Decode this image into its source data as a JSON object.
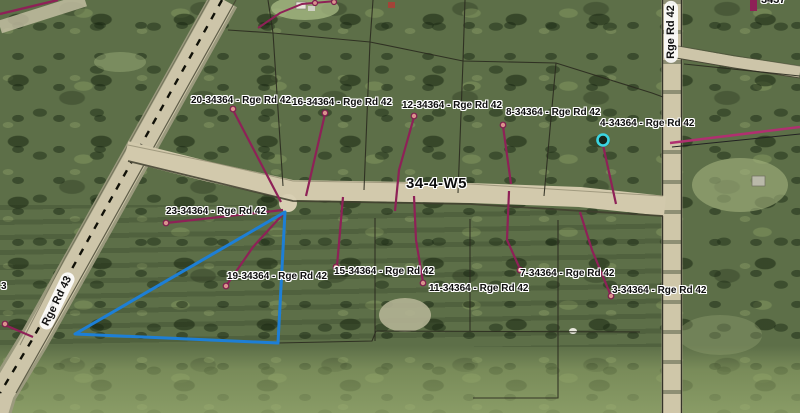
{
  "map": {
    "township_label": "34-4-W5",
    "road_labels": [
      {
        "name": "Rge Rd 43"
      },
      {
        "name": "Rge Rd 42"
      }
    ],
    "parcel_labels": [
      {
        "text": "20-34364 - Rge Rd 42"
      },
      {
        "text": "16-34364 - Rge Rd 42"
      },
      {
        "text": "12-34364 - Rge Rd 42"
      },
      {
        "text": "8-34364 - Rge Rd 42"
      },
      {
        "text": "4-34364 - Rge Rd 42"
      },
      {
        "text": "23-34364 - Rge Rd 42"
      },
      {
        "text": "19-34364 - Rge Rd 42"
      },
      {
        "text": "15-34364 - Rge Rd 42"
      },
      {
        "text": "11-34364 - Rge Rd 42"
      },
      {
        "text": "7-34364 - Rge Rd 42"
      },
      {
        "text": "3-34364 - Rge Rd 42"
      }
    ],
    "partial_labels": {
      "top_right": "3437",
      "left_edge": "3"
    },
    "colors": {
      "leader_line": "#8E2157",
      "selection_outline": "#1D7FD6",
      "selected_point_ring": "#3BD5E2",
      "road_fill": "#D2C9AC",
      "pipeline_line": "#B03070",
      "parcel_line": "#2B2B1F"
    }
  }
}
